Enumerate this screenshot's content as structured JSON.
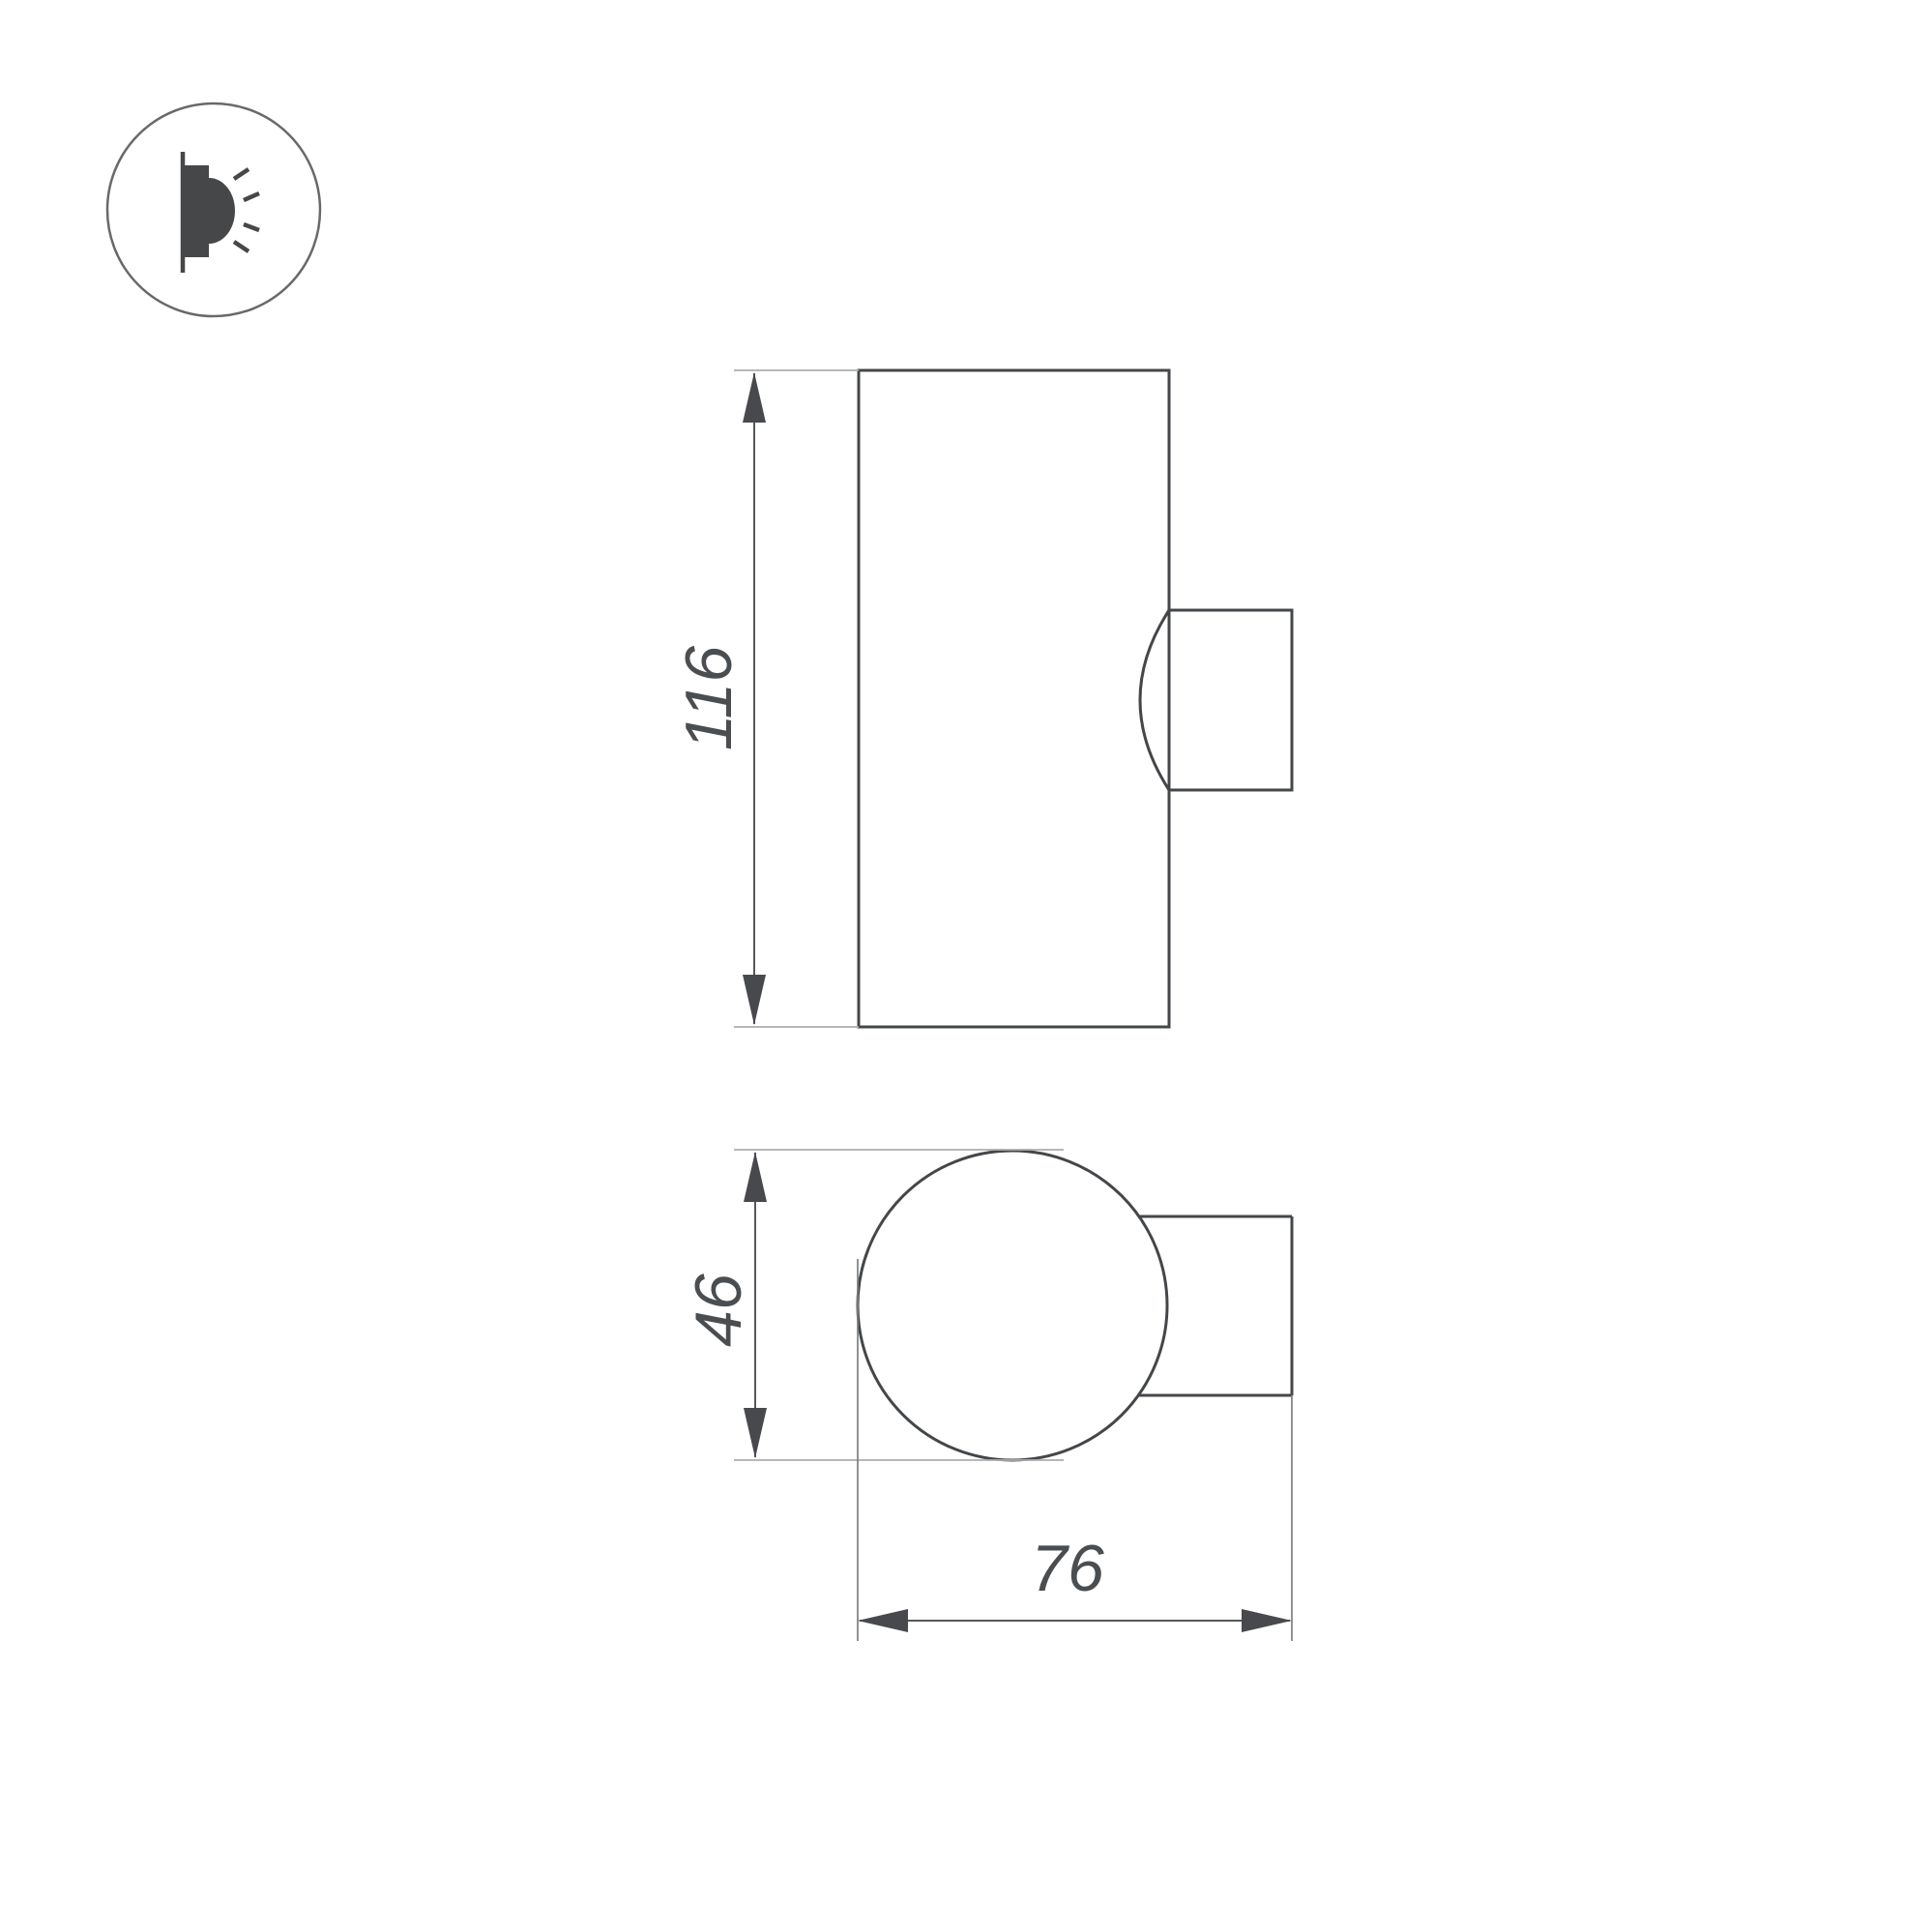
{
  "badge": {
    "icon": "wall-light-icon"
  },
  "views": {
    "front": {
      "height_label": "116"
    },
    "top": {
      "diameter_label": "46",
      "depth_label": "76"
    }
  },
  "colors": {
    "background": "#ffffff",
    "drawing_line": "#44474a",
    "dimension_line": "#55585b",
    "extension_line": "#abadaf",
    "arrow": "#47494c",
    "text": "#4b4e51",
    "icon": "#454749",
    "icon_circle": "#68696b"
  }
}
